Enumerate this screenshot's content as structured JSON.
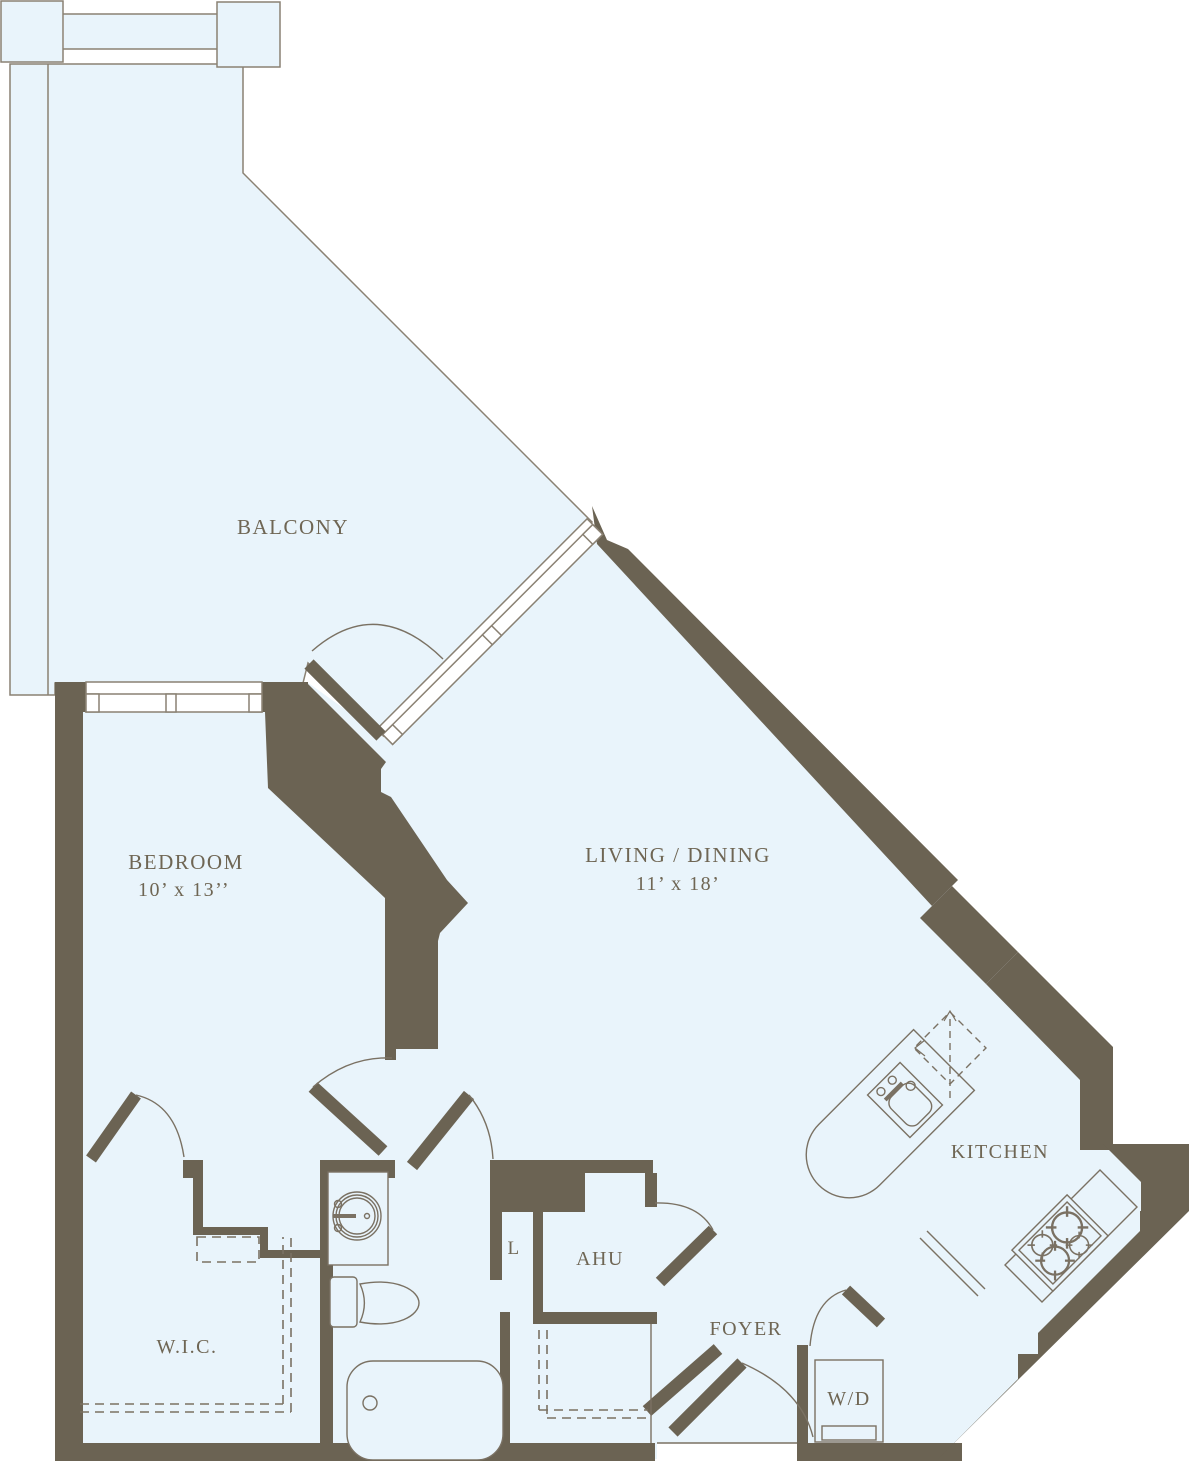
{
  "title": "Apartment Floor Plan",
  "colors": {
    "floor": "#e9f4fb",
    "wall": "#6b6353",
    "line": "#7a7163",
    "rail": "#8a8173",
    "text": "#6f6654",
    "background": "#ffffff"
  },
  "rooms": {
    "balcony": {
      "label": "BALCONY"
    },
    "bedroom": {
      "label": "BEDROOM",
      "dims": "10’ x 13’’"
    },
    "living_dining": {
      "label": "LIVING / DINING",
      "dims": "11’ x 18’"
    },
    "kitchen": {
      "label": "KITCHEN"
    },
    "wic": {
      "label": "W.I.C."
    },
    "linen_closet": {
      "label": "L"
    },
    "ahu": {
      "label": "AHU"
    },
    "foyer": {
      "label": "FOYER"
    },
    "washer_dryer": {
      "label": "W/D"
    }
  },
  "fixtures": [
    "kitchen-island",
    "island-sink-icon",
    "refrigerator-icon",
    "stove-icon",
    "bathroom-vanity",
    "bathroom-sink-icon",
    "toilet-icon",
    "bathtub-icon",
    "washer-dryer-icon",
    "bedroom-window",
    "balcony-window",
    "balcony-rail",
    "door-swing-arcs",
    "closet-rod-dashes"
  ]
}
